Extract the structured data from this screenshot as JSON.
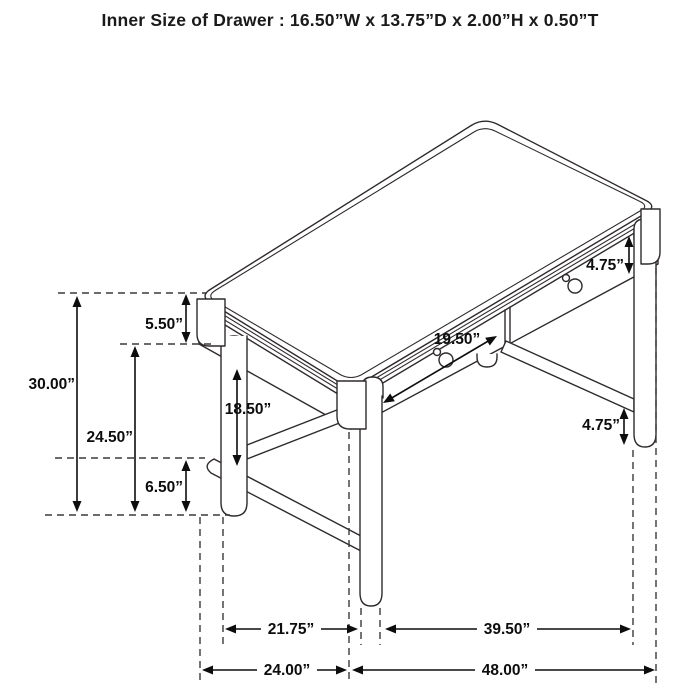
{
  "title": "Inner Size of Drawer : 16.50”W x 13.75”D x 2.00”H x 0.50”T",
  "dimensions": {
    "apron_height_right": "4.75”",
    "drawer_front_width": "19.50”",
    "desktop_edge_height": "5.50”",
    "overall_height": "30.00”",
    "underdesk_clearance": "24.50”",
    "side_clearance": "18.50”",
    "stretcher_floor_gap": "6.50”",
    "stretcher_height_right": "4.75”",
    "leg_span_side": "21.75”",
    "leg_span_front": "39.50”",
    "overall_depth": "24.00”",
    "overall_width": "48.00”"
  }
}
